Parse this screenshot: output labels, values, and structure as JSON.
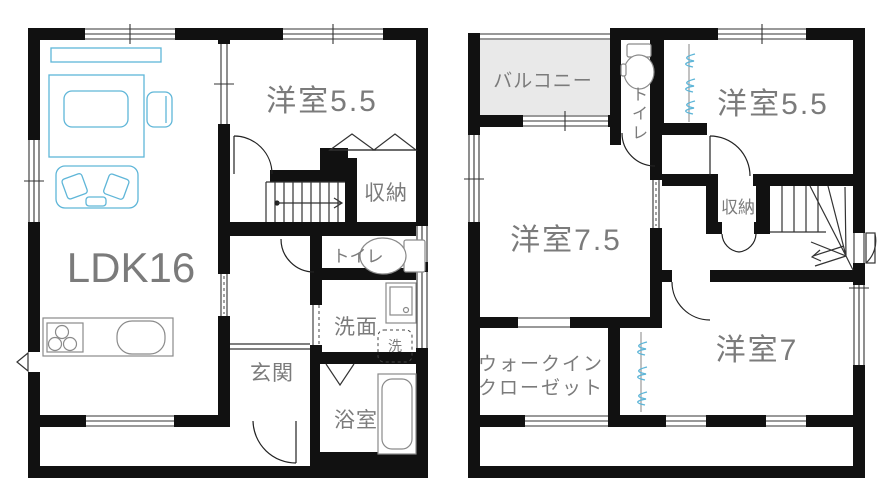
{
  "colors": {
    "wall": "#111111",
    "label_gray": "#7b7b7b",
    "furniture_blue": "#5fb6d8",
    "balcony_fill": "#e9e9e9"
  },
  "floor1": {
    "ldk": "LDK16",
    "western_room_55": "洋室5.5",
    "storage": "収納",
    "toilet": "トイレ",
    "entrance": "玄関",
    "washroom": "洗面",
    "washer": "洗",
    "bathroom": "浴室"
  },
  "floor2": {
    "balcony": "バルコニー",
    "toilet_chars": [
      "ト",
      "イ",
      "レ"
    ],
    "western_room_55": "洋室5.5",
    "western_room_75": "洋室7.5",
    "storage": "収納",
    "wic_line1": "ウォークイン",
    "wic_line2": "クローゼット",
    "western_room_7": "洋室7"
  }
}
